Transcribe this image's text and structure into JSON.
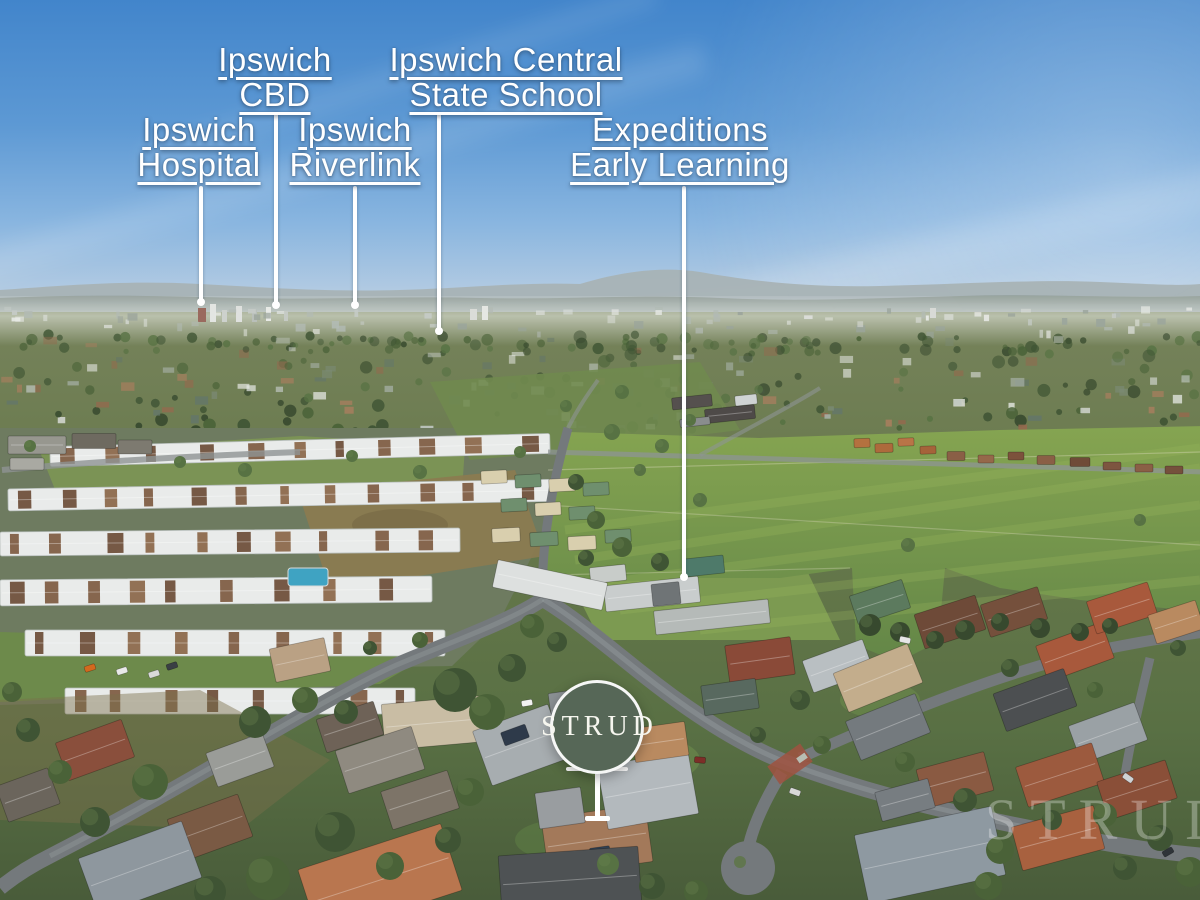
{
  "annotations": {
    "labels": [
      {
        "id": "ipswich-cbd",
        "lines": [
          "Ipswich",
          "CBD"
        ]
      },
      {
        "id": "ipswich-central-state-school",
        "lines": [
          "Ipswich Central",
          "State School"
        ]
      },
      {
        "id": "ipswich-hospital",
        "lines": [
          "Ipswich",
          "Hospital"
        ]
      },
      {
        "id": "ipswich-riverlink",
        "lines": [
          "Ipswich",
          "Riverlink"
        ]
      },
      {
        "id": "expeditions-early-learning",
        "lines": [
          "Expeditions",
          "Early Learning"
        ]
      }
    ]
  },
  "badge": {
    "brand": "STRUD"
  },
  "watermark": {
    "text": "STRUD"
  },
  "colors": {
    "badge_green": "#566757",
    "label_text": "#ffffff",
    "leader_line": "#ffffff",
    "sky_top": "#4285cb",
    "sky_horizon": "#c9d6e1",
    "pasture_green": "#7aa04e"
  },
  "scene": {
    "estate_rows": [
      [
        50,
        440,
        500,
        20,
        -1.5
      ],
      [
        8,
        484,
        560,
        22,
        -1
      ],
      [
        0,
        530,
        460,
        24,
        -0.5
      ],
      [
        0,
        578,
        432,
        26,
        -0.5
      ],
      [
        25,
        630,
        420,
        26,
        0
      ],
      [
        65,
        688,
        350,
        26,
        0
      ]
    ],
    "tree_palette": [
      "#3f5434",
      "#4a6238",
      "#577243",
      "#37492e"
    ],
    "houses": [
      [
        37,
        445,
        58,
        18,
        0,
        "#97978f"
      ],
      [
        94,
        441,
        44,
        15,
        0,
        "#6e6a60"
      ],
      [
        27,
        464,
        34,
        12,
        0,
        "#a9a9a2"
      ],
      [
        135,
        447,
        34,
        14,
        0,
        "#7d7a70"
      ],
      [
        692,
        402,
        40,
        12,
        -6,
        "#55504e"
      ],
      [
        730,
        414,
        50,
        14,
        -6,
        "#4e4a48"
      ],
      [
        695,
        422,
        30,
        8,
        -6,
        "#8a8d8e"
      ],
      [
        746,
        400,
        22,
        10,
        -6,
        "#cfd3d3"
      ],
      [
        494,
        477,
        26,
        13,
        -3,
        "#d9cfae"
      ],
      [
        528,
        481,
        26,
        13,
        -3,
        "#6f8f6e"
      ],
      [
        562,
        485,
        26,
        13,
        -3,
        "#d9cfae"
      ],
      [
        596,
        489,
        26,
        13,
        -3,
        "#6f8f6e"
      ],
      [
        514,
        505,
        26,
        13,
        -3,
        "#6f8f6e"
      ],
      [
        548,
        509,
        26,
        13,
        -3,
        "#d9cfae"
      ],
      [
        582,
        513,
        26,
        13,
        -3,
        "#6f8f6e"
      ],
      [
        506,
        535,
        28,
        14,
        -3,
        "#d9cfae"
      ],
      [
        544,
        539,
        28,
        14,
        -3,
        "#6f8f6e"
      ],
      [
        582,
        543,
        28,
        14,
        -3,
        "#d9cfae"
      ],
      [
        618,
        536,
        26,
        13,
        -3,
        "#6f8f6e"
      ],
      [
        862,
        443,
        16,
        9,
        -2,
        "#b4713f"
      ],
      [
        884,
        448,
        18,
        9,
        -2,
        "#ad6a3c"
      ],
      [
        906,
        442,
        16,
        8,
        -2,
        "#b97447"
      ],
      [
        928,
        450,
        16,
        8,
        -2,
        "#a5633a"
      ],
      [
        956,
        456,
        18,
        9,
        0,
        "#8a5f46"
      ],
      [
        986,
        459,
        16,
        8,
        0,
        "#95684a"
      ],
      [
        1016,
        456,
        16,
        8,
        0,
        "#7c523c"
      ],
      [
        1046,
        460,
        18,
        9,
        0,
        "#8a5f46"
      ],
      [
        1080,
        462,
        20,
        9,
        0,
        "#6f4b38"
      ],
      [
        1112,
        466,
        18,
        8,
        0,
        "#7d5540"
      ],
      [
        1144,
        468,
        18,
        8,
        0,
        "#8a5f46"
      ],
      [
        1174,
        470,
        18,
        8,
        0,
        "#75503c"
      ],
      [
        652,
        594,
        95,
        26,
        -6,
        "#c9cdcd"
      ],
      [
        712,
        617,
        115,
        24,
        -6,
        "#b5bab8"
      ],
      [
        666,
        594,
        28,
        22,
        -6,
        "#6f7476"
      ],
      [
        704,
        566,
        40,
        18,
        -6,
        "#4e7a6a"
      ],
      [
        608,
        574,
        36,
        16,
        -6,
        "#c8ccc9"
      ],
      [
        550,
        585,
        112,
        28,
        12,
        "#dde0df"
      ],
      [
        575,
        706,
        50,
        32,
        -8,
        "#8b9194"
      ],
      [
        760,
        660,
        66,
        38,
        -8,
        "#8a4a38"
      ],
      [
        730,
        697,
        55,
        30,
        -8,
        "#58695f"
      ],
      [
        838,
        666,
        64,
        34,
        -20,
        "#b9bfc2"
      ],
      [
        878,
        678,
        80,
        42,
        -22,
        "#c3ad8c"
      ],
      [
        888,
        727,
        75,
        42,
        -22,
        "#747a7e"
      ],
      [
        880,
        602,
        55,
        30,
        -18,
        "#5c7a5e"
      ],
      [
        950,
        622,
        64,
        36,
        -18,
        "#6e4a38"
      ],
      [
        1014,
        612,
        60,
        34,
        -18,
        "#75503c"
      ],
      [
        1075,
        652,
        70,
        38,
        -20,
        "#a8593c"
      ],
      [
        1122,
        608,
        64,
        34,
        -18,
        "#a8593c"
      ],
      [
        1176,
        622,
        50,
        30,
        -18,
        "#b98a60"
      ],
      [
        1035,
        700,
        75,
        40,
        -20,
        "#4c4f51"
      ],
      [
        1108,
        733,
        70,
        40,
        -20,
        "#9aa1a5"
      ],
      [
        1060,
        775,
        80,
        42,
        -18,
        "#9c5a3e"
      ],
      [
        1137,
        790,
        72,
        40,
        -18,
        "#8a4f38"
      ],
      [
        1058,
        838,
        85,
        45,
        -15,
        "#a8613f"
      ],
      [
        930,
        855,
        140,
        70,
        -12,
        "#8e99a1"
      ],
      [
        955,
        780,
        70,
        40,
        -15,
        "#8a5a42"
      ],
      [
        905,
        800,
        55,
        30,
        -15,
        "#777d81"
      ],
      [
        433,
        723,
        100,
        46,
        -5,
        "#c9bda4"
      ],
      [
        520,
        745,
        80,
        58,
        -20,
        "#a7adb0"
      ],
      [
        515,
        735,
        26,
        14,
        -20,
        "#2e3a4a"
      ],
      [
        597,
        840,
        105,
        58,
        -8,
        "#a3795a"
      ],
      [
        600,
        852,
        20,
        10,
        -8,
        "#304052"
      ],
      [
        560,
        808,
        46,
        36,
        -8,
        "#999da0"
      ],
      [
        648,
        790,
        92,
        64,
        -10,
        "#b3b9bd"
      ],
      [
        570,
        880,
        140,
        58,
        -4,
        "#4e5254"
      ],
      [
        660,
        742,
        54,
        34,
        -8,
        "#b98a60"
      ],
      [
        380,
        760,
        80,
        45,
        -18,
        "#8f8a80"
      ],
      [
        420,
        800,
        70,
        40,
        -18,
        "#7d7468"
      ],
      [
        350,
        727,
        60,
        35,
        -18,
        "#6e6257"
      ],
      [
        300,
        660,
        56,
        34,
        -12,
        "#baa184"
      ],
      [
        95,
        750,
        70,
        40,
        -20,
        "#8a4f3c"
      ],
      [
        28,
        795,
        55,
        38,
        -20,
        "#6b655c"
      ],
      [
        210,
        828,
        75,
        45,
        -20,
        "#7a5a44"
      ],
      [
        140,
        868,
        110,
        60,
        -20,
        "#8e979e"
      ],
      [
        380,
        880,
        150,
        70,
        -18,
        "#b9764f"
      ],
      [
        240,
        760,
        60,
        36,
        -20,
        "#9a9c98"
      ]
    ],
    "trees": [
      [
        455,
        690,
        22,
        0
      ],
      [
        487,
        712,
        18,
        1
      ],
      [
        512,
        668,
        14,
        0
      ],
      [
        532,
        626,
        12,
        1
      ],
      [
        557,
        642,
        10,
        0
      ],
      [
        596,
        520,
        9,
        1
      ],
      [
        576,
        482,
        8,
        0
      ],
      [
        622,
        547,
        10,
        1
      ],
      [
        586,
        558,
        8,
        0
      ],
      [
        255,
        722,
        16,
        0
      ],
      [
        305,
        700,
        13,
        1
      ],
      [
        346,
        712,
        12,
        0
      ],
      [
        150,
        782,
        18,
        1
      ],
      [
        95,
        822,
        15,
        0
      ],
      [
        60,
        772,
        12,
        1
      ],
      [
        335,
        832,
        20,
        0
      ],
      [
        268,
        878,
        22,
        1
      ],
      [
        210,
        892,
        16,
        0
      ],
      [
        390,
        866,
        14,
        1
      ],
      [
        28,
        730,
        12,
        0
      ],
      [
        12,
        692,
        10,
        1
      ],
      [
        448,
        840,
        13,
        0
      ],
      [
        470,
        792,
        14,
        1
      ],
      [
        608,
        864,
        11,
        2
      ],
      [
        652,
        886,
        13,
        0
      ],
      [
        696,
        892,
        12,
        1
      ],
      [
        800,
        700,
        10,
        0
      ],
      [
        822,
        745,
        9,
        1
      ],
      [
        758,
        735,
        8,
        0
      ],
      [
        905,
        762,
        10,
        1
      ],
      [
        965,
        800,
        12,
        0
      ],
      [
        1000,
        850,
        14,
        1
      ],
      [
        1052,
        820,
        10,
        0
      ],
      [
        1105,
        815,
        12,
        1
      ],
      [
        1160,
        838,
        13,
        0
      ],
      [
        1190,
        872,
        15,
        1
      ],
      [
        1125,
        868,
        12,
        0
      ],
      [
        988,
        886,
        14,
        1
      ],
      [
        1010,
        668,
        9,
        0
      ],
      [
        1095,
        690,
        8,
        1
      ],
      [
        1178,
        648,
        8,
        0
      ],
      [
        870,
        625,
        11,
        3
      ],
      [
        900,
        632,
        10,
        3
      ],
      [
        935,
        640,
        9,
        3
      ],
      [
        965,
        630,
        10,
        3
      ],
      [
        1000,
        622,
        9,
        3
      ],
      [
        1040,
        628,
        10,
        3
      ],
      [
        1080,
        632,
        9,
        3
      ],
      [
        1110,
        626,
        8,
        3
      ],
      [
        908,
        545,
        7,
        2
      ],
      [
        1140,
        520,
        6,
        2
      ],
      [
        700,
        500,
        7,
        2
      ],
      [
        640,
        470,
        6,
        2
      ],
      [
        245,
        470,
        7,
        2
      ],
      [
        180,
        462,
        6,
        2
      ],
      [
        352,
        456,
        6,
        2
      ],
      [
        420,
        472,
        7,
        2
      ],
      [
        520,
        452,
        6,
        2
      ],
      [
        612,
        432,
        8,
        2
      ],
      [
        662,
        446,
        7,
        2
      ],
      [
        566,
        406,
        6,
        2
      ],
      [
        622,
        392,
        7,
        2
      ],
      [
        690,
        420,
        6,
        2
      ],
      [
        30,
        446,
        6,
        2
      ],
      [
        660,
        562,
        9,
        0
      ],
      [
        420,
        640,
        8,
        1
      ],
      [
        370,
        648,
        7,
        0
      ]
    ],
    "cars": [
      [
        90,
        668,
        -18,
        "#d2691e"
      ],
      [
        122,
        671,
        -18,
        "#e9e9e9"
      ],
      [
        154,
        674,
        -18,
        "#dadada"
      ],
      [
        172,
        666,
        -18,
        "#3a3f44"
      ],
      [
        527,
        703,
        -10,
        "#f2f2f2"
      ],
      [
        905,
        640,
        12,
        "#e6e6e6"
      ],
      [
        1128,
        778,
        35,
        "#cfd3d6"
      ],
      [
        1168,
        852,
        -30,
        "#2f3438"
      ],
      [
        700,
        760,
        5,
        "#7d2e28"
      ],
      [
        795,
        792,
        20,
        "#d8d8d8"
      ]
    ]
  }
}
